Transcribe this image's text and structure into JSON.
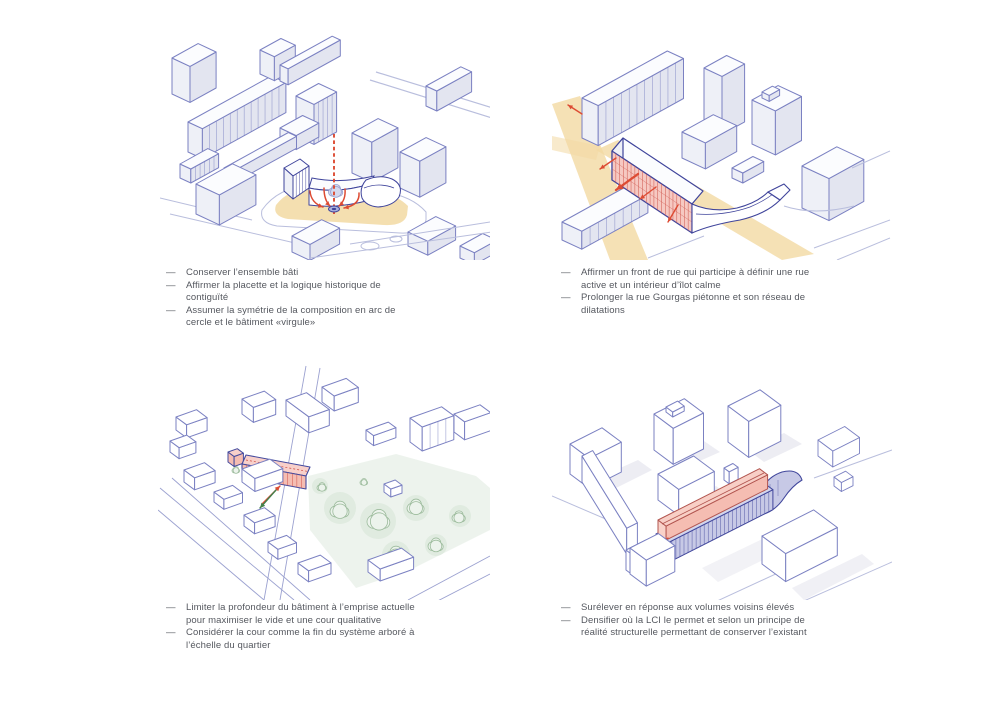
{
  "page": {
    "background": "#ffffff"
  },
  "bullet": "—",
  "figures": [
    {
      "name": "conserver-ensemble-bati",
      "bullets": [
        [
          "Conserver l’ensemble bâti"
        ],
        [
          "Affirmer la placette et la logique historique de",
          "contiguïté"
        ],
        [
          "Assumer la symétrie de la composition en arc de",
          "cercle et le bâtiment «virgule»"
        ]
      ]
    },
    {
      "name": "front-de-rue",
      "bullets": [
        [
          "Affirmer un front de rue qui participe à définir une rue",
          "active et un intérieur d’îlot calme"
        ],
        [
          "Prolonger la rue Gourgas piétonne et son réseau de",
          "dilatations"
        ]
      ]
    },
    {
      "name": "profondeur-batiment",
      "bullets": [
        [
          "Limiter la profondeur du bâtiment à l’emprise actuelle",
          "pour maximiser le vide et une cour qualitative"
        ],
        [
          "Considérer la cour comme la fin du système arboré à",
          "l’échelle du quartier"
        ]
      ]
    },
    {
      "name": "surelever",
      "bullets": [
        [
          "Surélever en réponse aux volumes voisins élevés"
        ],
        [
          "Densifier où la LCI le permet et selon un principe de",
          "réalité structurelle permettant de conserver l’existant"
        ]
      ]
    }
  ],
  "colors": {
    "text": "#55585f",
    "line": "#7b81c2",
    "line_dark": "#3f449b",
    "face_top": "#fbfcfe",
    "face_sw": "#eef0f7",
    "face_se": "#e3e5f0",
    "street_line": "#b9bedd",
    "yellow": "#f2d9a2",
    "red": "#dd4b33",
    "red_hatch": "#cf574e",
    "pink_face": "#f5bdb2",
    "pink_top": "#f8cfc6",
    "pink_light": "#f8d0ca",
    "green_line": "#9cbb9c",
    "green_fill": "#ecf3ec",
    "park_fill": "#eaf1ea",
    "park_blob": "#e0ebe0",
    "green_arrow": "#44804c",
    "purple_face": "#c7c9e6",
    "purple_top": "#d3d5ec",
    "tree_blue": "#d4d9ee",
    "tree_blue_line": "#99a1cf",
    "fountain": "#a9b1dd",
    "shadow": "#e6e6ee",
    "white": "#ffffff"
  }
}
